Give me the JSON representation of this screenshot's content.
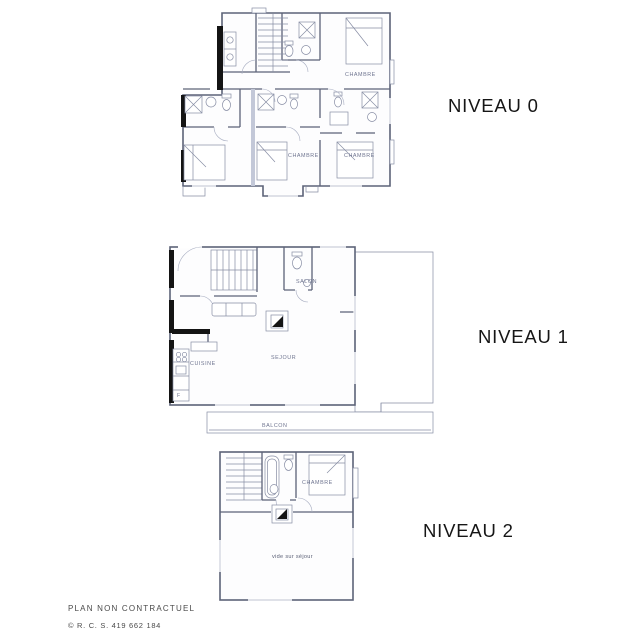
{
  "plans": {
    "n0": {
      "label": "NIVEAU 0",
      "chambre_top": "CHAMBRE",
      "chambre_mid": "CHAMBRE",
      "chambre_right": "CHAMBRE"
    },
    "n1": {
      "label": "NIVEAU 1",
      "salon": "SALON",
      "sejour": "SEJOUR",
      "cuisine": "CUISINE",
      "balcon": "BALCON",
      "fridge": "F"
    },
    "n2": {
      "label": "NIVEAU 2",
      "chambre": "CHAMBRE",
      "vide": "vide sur séjour"
    }
  },
  "footer": {
    "disclaimer": "PLAN NON CONTRACTUEL",
    "rcs": "© R. C. S. 419 662 184"
  },
  "colors": {
    "background": "#ffffff",
    "wall": "#5d6378",
    "wall_thin": "#878da4",
    "wall_black": "#141414",
    "room_fill": "#fdfdfe",
    "label": "#161616",
    "room_label": "#6f7590",
    "footer": "#4a4a4a"
  }
}
